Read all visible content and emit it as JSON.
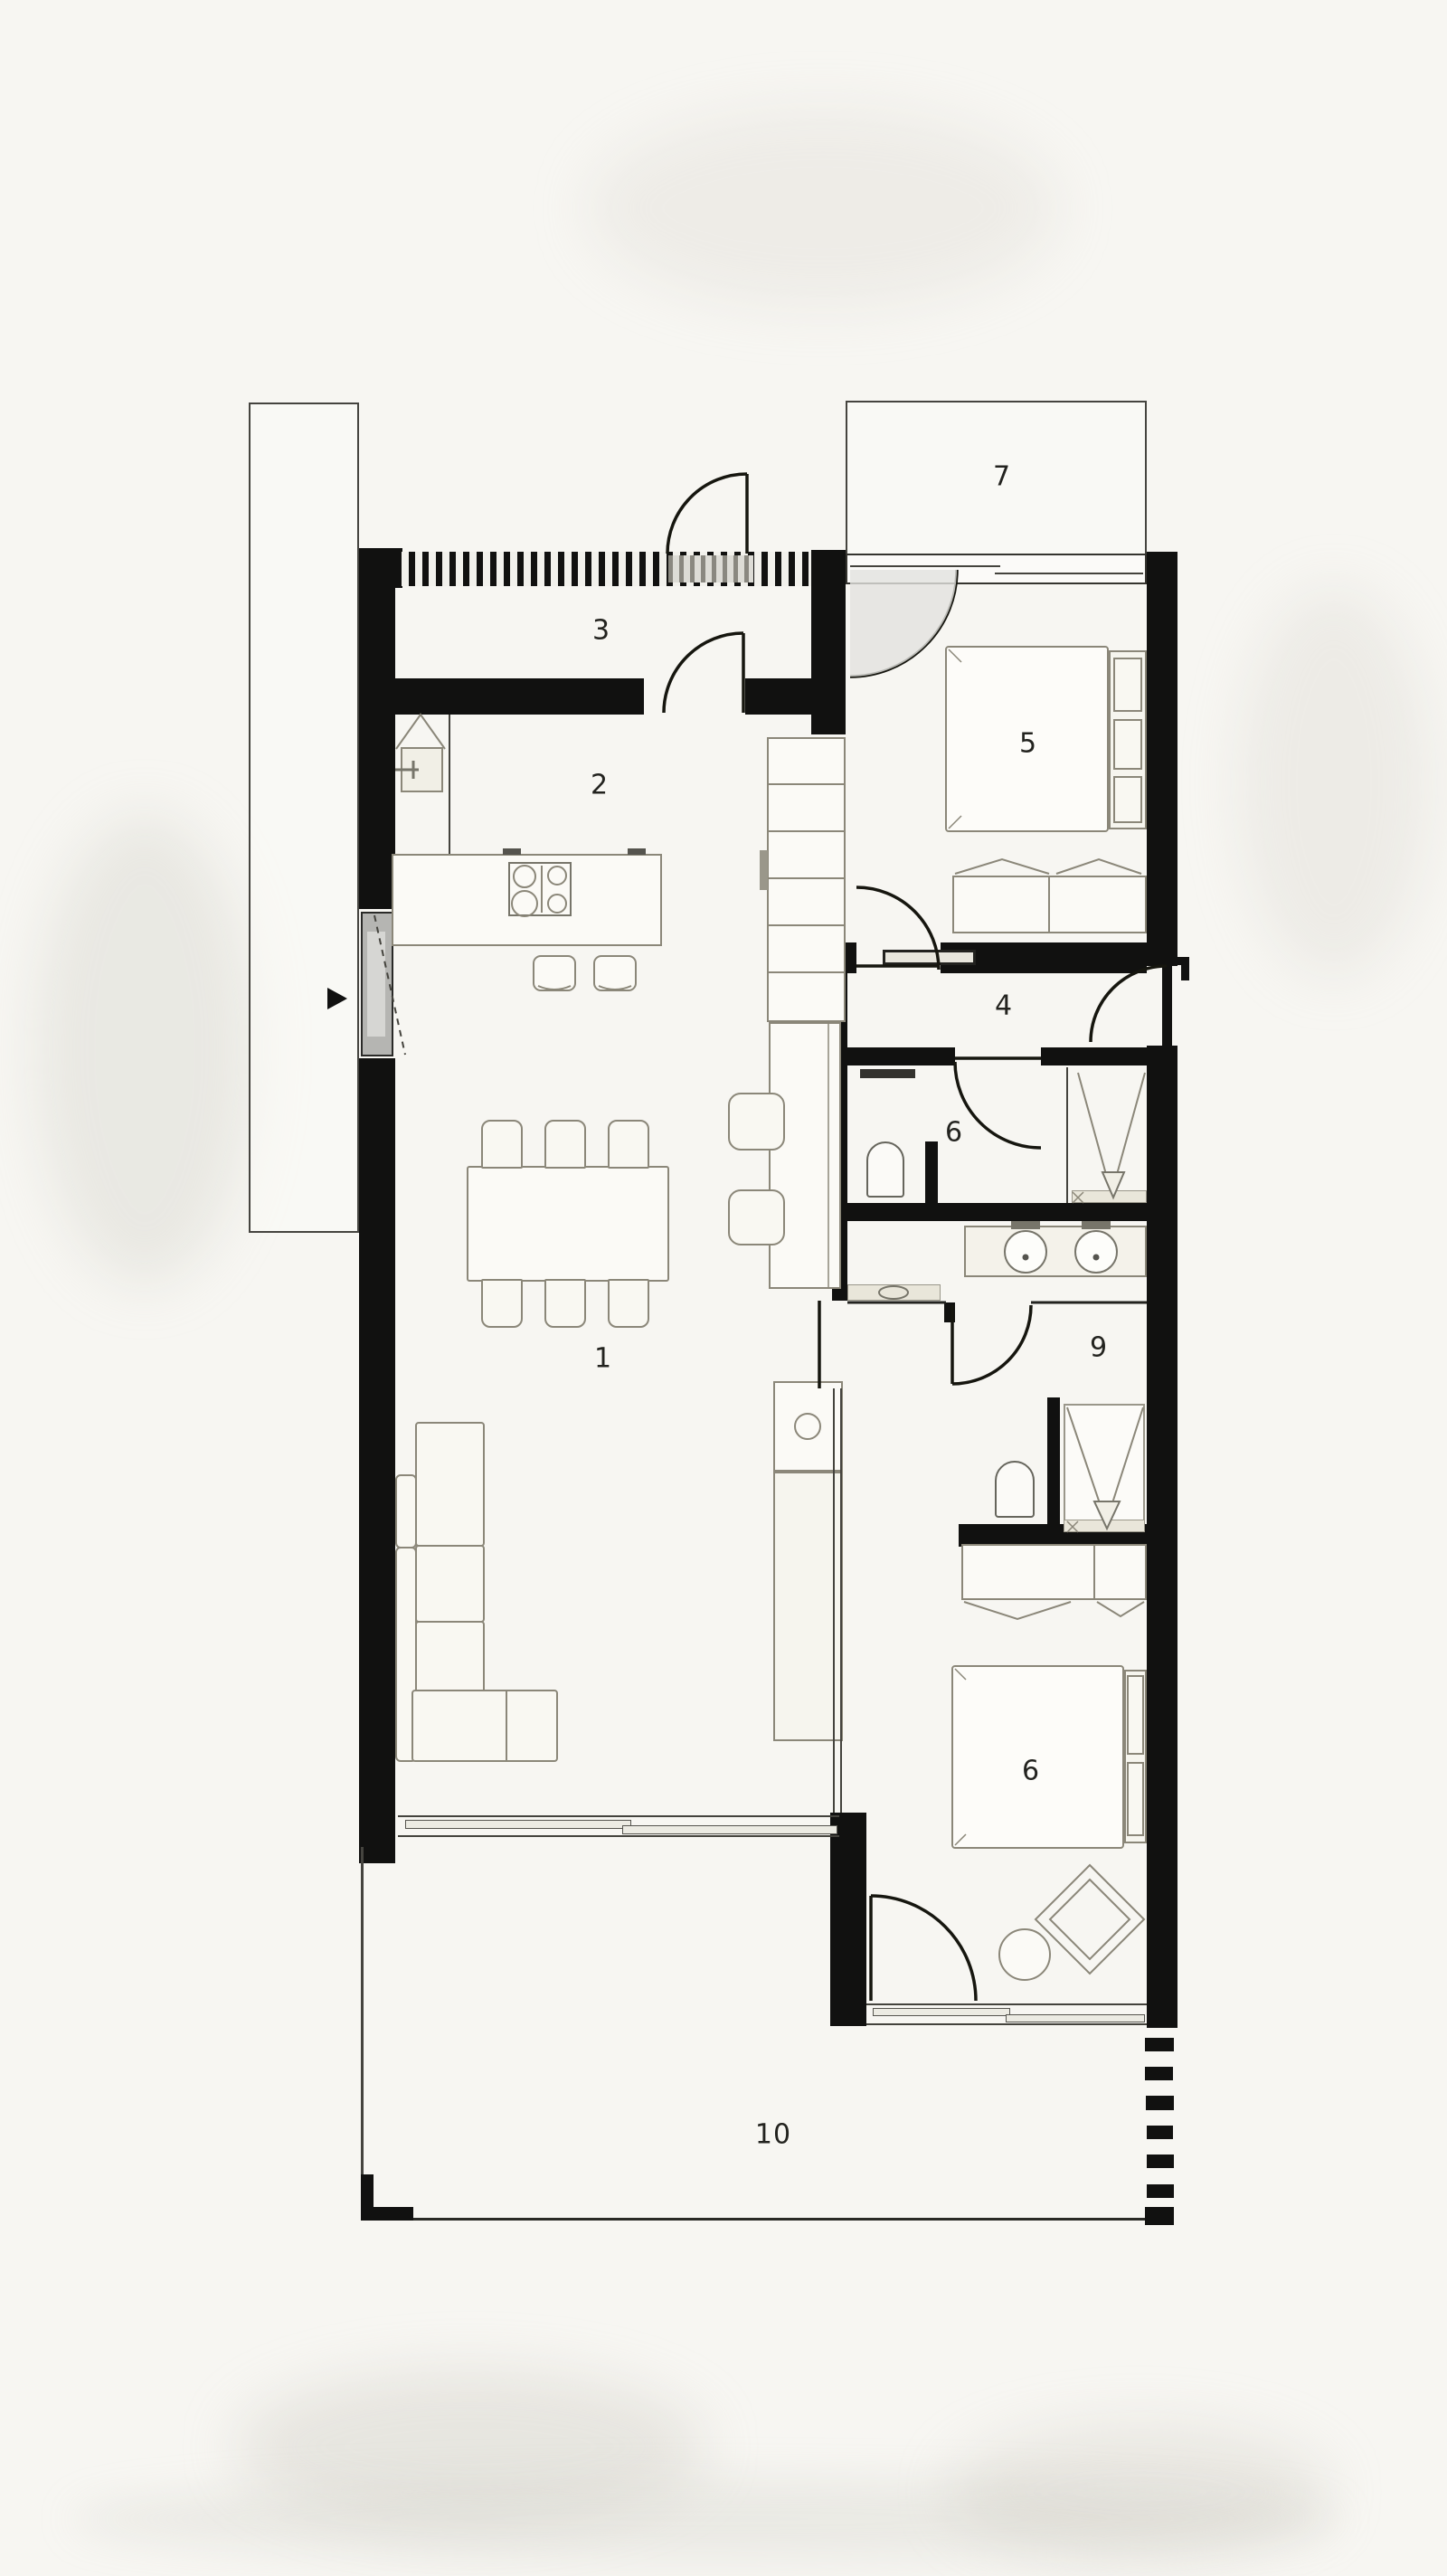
{
  "plan": {
    "type": "residential-floor-plan",
    "rooms": [
      {
        "label": "1",
        "name": "living-dining-room"
      },
      {
        "label": "2",
        "name": "kitchen"
      },
      {
        "label": "3",
        "name": "entry-hall"
      },
      {
        "label": "4",
        "name": "corridor"
      },
      {
        "label": "5",
        "name": "bedroom-top"
      },
      {
        "label": "6",
        "name": "bathroom"
      },
      {
        "label": "7",
        "name": "terrace-top"
      },
      {
        "label": "9",
        "name": "ensuite-dressing"
      },
      {
        "label": "6",
        "name": "bedroom-bottom"
      },
      {
        "label": "10",
        "name": "terrace-bottom"
      }
    ],
    "colors": {
      "paper": "#f7f6f2",
      "wall": "#111110",
      "furniture_line": "#8b8779",
      "beige_fill": "#e9e6da",
      "shade_gray": "#e2e2df"
    }
  }
}
